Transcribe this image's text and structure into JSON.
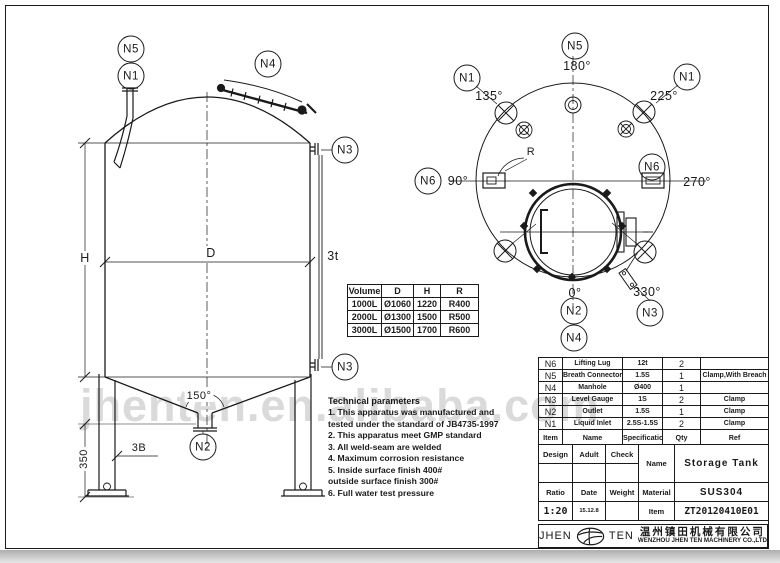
{
  "watermark": "jhenten.en.alibaba.com",
  "elevation": {
    "callouts": {
      "n5": "N5",
      "n1": "N1",
      "n4": "N4",
      "n3_top": "N3",
      "n3_bottom": "N3",
      "n2": "N2"
    },
    "dims": {
      "h": "H",
      "d": "D",
      "t3": "3t",
      "cone_angle": "150°",
      "b3": "3B",
      "leg_height": "350"
    }
  },
  "top_view": {
    "callouts": {
      "n5": "N5",
      "n1_left": "N1",
      "n1_right": "N1",
      "n6_left": "N6",
      "n6_right": "N6",
      "n2": "N2",
      "n4": "N4",
      "n3": "N3"
    },
    "angles": {
      "a0": "0°",
      "a90": "90°",
      "a135": "135°",
      "a180": "180°",
      "a225": "225°",
      "a270": "270°",
      "a330": "330°"
    },
    "radius_label": "R"
  },
  "size_table": {
    "headers": [
      "Volume",
      "D",
      "H",
      "R"
    ],
    "rows": [
      [
        "1000L",
        "Ø1060",
        "1220",
        "R400"
      ],
      [
        "2000L",
        "Ø1300",
        "1500",
        "R500"
      ],
      [
        "3000L",
        "Ø1500",
        "1700",
        "R600"
      ]
    ]
  },
  "tech_params": {
    "title": "Technical parameters",
    "items": [
      "1. This apparatus was manufactured and\n    tested under the standard of JB4735-1997",
      "2. This apparatus meet GMP standard",
      "3. All weld-seam are welded",
      "4. Maximum corrosion resistance",
      "5. Inside surface finish 400#\n    outside surface finish 300#",
      "6. Full water test pressure"
    ]
  },
  "parts_table": {
    "headers": [
      "Item",
      "Name",
      "Specification",
      "Qty",
      "Ref"
    ],
    "rows": [
      [
        "N6",
        "Lifting Lug",
        "12t",
        "2",
        ""
      ],
      [
        "N5",
        "Breath Connector",
        "1.5S",
        "1",
        "Clamp,With Breach"
      ],
      [
        "N4",
        "Manhole",
        "Ø400",
        "1",
        ""
      ],
      [
        "N3",
        "Level Gauge",
        "1S",
        "2",
        "Clamp"
      ],
      [
        "N2",
        "Outlet",
        "1.5S",
        "1",
        "Clamp"
      ],
      [
        "N1",
        "Liquid Inlet",
        "2.5S-1.5S",
        "2",
        "Clamp"
      ]
    ]
  },
  "title_block": {
    "design": "Design",
    "audit": "Adult",
    "check": "Check",
    "name_label": "Name",
    "name_value": "Storage Tank",
    "ratio_label": "Ratio",
    "date_label": "Date",
    "weight_label": "Weight",
    "material_label": "Material",
    "material_value": "SUS304",
    "ratio_value": "1:20",
    "date_value": "15.12.8",
    "item_label": "Item",
    "item_value": "ZT20120410E01"
  },
  "logo": {
    "left": "JHEN",
    "right": "TEN",
    "company_cn": "温州镇田机械有限公司",
    "company_en": "WENZHOU JHEN TEN MACHINERY CO.,LTD"
  }
}
